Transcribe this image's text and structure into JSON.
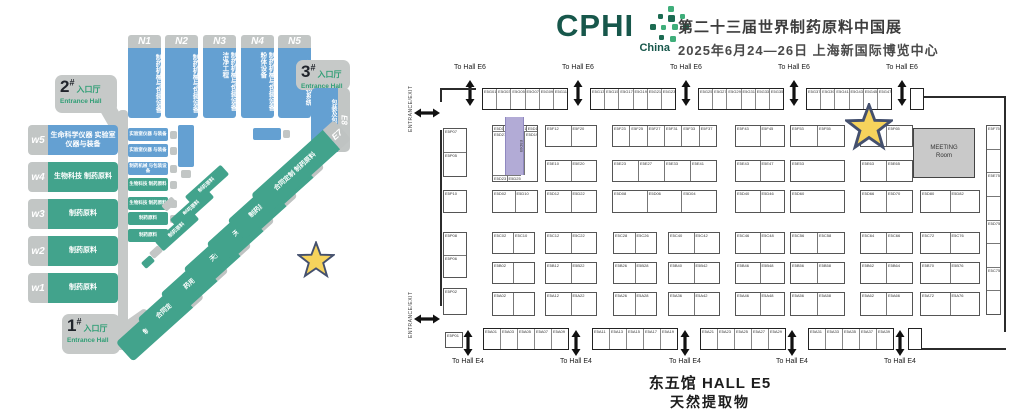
{
  "header": {
    "logo": "CPHI",
    "logo_sub": "China",
    "title": "第二十三届世界制药原料中国展",
    "date_venue": "2025年6月24—26日  上海新国际博览中心"
  },
  "venue_map": {
    "entrances": [
      {
        "num": "1",
        "hash": "#",
        "cn": "入口厅",
        "en": "Entrance Hall"
      },
      {
        "num": "2",
        "hash": "#",
        "cn": "入口厅",
        "en": "Entrance Hall"
      },
      {
        "num": "3",
        "hash": "#",
        "cn": "入口厅",
        "en": "Entrance Hall"
      }
    ],
    "n_halls": [
      {
        "id": "N1",
        "label": "制药机械与包装设备"
      },
      {
        "id": "N2",
        "label": "制药机械与包装设备"
      },
      {
        "id": "N3",
        "label": "制药机械与包装设备 洁净工程"
      },
      {
        "id": "N4",
        "label": "制药机械与包装设备 粉体设备"
      },
      {
        "id": "N5",
        "label": "包装及包材系统"
      }
    ],
    "w_halls": [
      {
        "id": "w5",
        "label": "生命科学仪器 实验室仪器与装备",
        "color": "blue"
      },
      {
        "id": "w4",
        "label": "生物科技 制药原料",
        "color": "green"
      },
      {
        "id": "w3",
        "label": "制药原料",
        "color": "green"
      },
      {
        "id": "w2",
        "label": "制药原料",
        "color": "green"
      },
      {
        "id": "w1",
        "label": "制药原料",
        "color": "green"
      }
    ],
    "e8": {
      "id": "E8",
      "label": "包装及包材系统"
    },
    "e_halls": [
      {
        "id": "E1",
        "label": "制药原料"
      },
      {
        "id": "E2",
        "label": "合同定制 制药原料"
      },
      {
        "id": "E3",
        "label": "药用辅料 制剂"
      },
      {
        "id": "E4",
        "label": "天然提取物"
      },
      {
        "id": "E5",
        "label": "天然提取物"
      },
      {
        "id": "E6",
        "label": "制药原料 药用辅料"
      },
      {
        "id": "E7",
        "label": "合同定制 制药原料"
      }
    ],
    "mid_boxes": [
      {
        "label": "实验室仪器 与装备",
        "color": "blue"
      },
      {
        "label": "实验室仪器 与装备",
        "color": "blue"
      },
      {
        "label": "制药机械 与包装设备",
        "color": "blue"
      },
      {
        "label": "生物科技 制药原料",
        "color": "green"
      },
      {
        "label": "生物科技 制药原料",
        "color": "green"
      },
      {
        "label": "制药原料",
        "color": "green"
      },
      {
        "label": "制药原料",
        "color": "green"
      }
    ],
    "small_diags": [
      "制药原料",
      "制药原料",
      "制药原料"
    ]
  },
  "floor_plan": {
    "to_hall_top": "To Hall E6",
    "to_hall_bottom": "To Hall E4",
    "entrance_exit": "ENTRANCE/EXIT",
    "meeting_room_line1": "MEETING",
    "meeting_room_line2": "Room",
    "hall_title": "东五馆  HALL E5",
    "hall_subtitle": "天然提取物",
    "wall_top": [
      [
        "E5G01",
        "E5G03",
        "E5G05",
        "E5G07",
        "E5G09",
        "E5G11"
      ],
      [
        "E5G13",
        "E5G15",
        "E5G17",
        "E5G19",
        "E5G21",
        "E5G23"
      ],
      [
        "E5G25",
        "E5G27",
        "E5G29",
        "E5G31",
        "E5G33",
        "E5G35"
      ],
      [
        "E5G37",
        "E5G39",
        "E5G41",
        "E5G43",
        "E5G45",
        "E5G47"
      ]
    ],
    "wall_bottom": [
      [
        "E5A01",
        "E5A03",
        "E5A05",
        "E5A07",
        "E5A09"
      ],
      [
        "E5A11",
        "E5A13",
        "E5A15",
        "E5A17",
        "E5A19"
      ],
      [
        "E5A21",
        "E5A23",
        "E5A25",
        "E5A27",
        "E5A29"
      ],
      [
        "E5A31",
        "E5A33",
        "E5A35",
        "E5A37",
        "E5A39"
      ]
    ],
    "rowF": [
      "E5F12",
      "E5F20",
      "E5F23",
      "E5F25",
      "E5F27",
      "E5F31",
      "E5F33",
      "E5F37",
      "E5F43",
      "E5F45",
      "E5F53",
      "E5F55",
      "E5F63",
      "E5F65"
    ],
    "rowE": [
      "E5E10",
      "E5E20",
      "E5E23",
      "E5E27",
      "E5E33",
      "E5E41",
      "E5E43",
      "E5E47",
      "E5E53",
      "E5E63",
      "E5E65"
    ],
    "rowD": [
      "E5D02",
      "E5D10",
      "E5D12",
      "E5D22",
      "E5D08",
      "E5D06",
      "E5D04",
      "E5D40",
      "E5D46",
      "E5D60",
      "E5D66",
      "E5D70",
      "E5D80",
      "E5D82"
    ],
    "rowC": [
      "E5C02",
      "E5C10",
      "E5C12",
      "E5C22",
      "E5C28",
      "E5C26",
      "E5C40",
      "E5C42",
      "E5C46",
      "E5C48",
      "E5C56",
      "E5C58",
      "E5C64",
      "E5C66",
      "E5C72",
      "E5C76"
    ],
    "rowB": [
      "E5B02",
      "",
      "E5B12",
      "E5B22",
      "E5B26",
      "E5B28",
      "E5B40",
      "E5B42",
      "E5B46",
      "E5B48",
      "E5B56",
      "E5B58",
      "E5B62",
      "E5B64",
      "E5B70",
      "E5B76"
    ],
    "rowA": [
      "E5A02",
      "",
      "E5A12",
      "E5A22",
      "E5A26",
      "E5A28",
      "E5A36",
      "E5A42",
      "E5A46",
      "E5A48",
      "E5A56",
      "E5A58",
      "E5A62",
      "E5A66",
      "E5A72",
      "E5A76"
    ],
    "p_col": [
      "E5P07",
      "E5P05",
      "E5P10",
      "E5P08",
      "E5P06",
      "E5P02"
    ],
    "right_col": [
      "E5F75",
      "",
      "E5E75",
      "",
      "E5D75",
      "",
      "E5C75",
      ""
    ],
    "corner_booth": "E5P01",
    "purple_block": {
      "cells": [
        "E5D11",
        "E5D13",
        "E5D15",
        "E5D17",
        "E5D21",
        "E5D19",
        "E5D23",
        "E5D25"
      ],
      "center": "E5D05"
    }
  },
  "colors": {
    "hall_blue": "#64a0d2",
    "hall_green": "#42a38c",
    "gray": "#c2c6c5",
    "entrance_green": "#2f9e75",
    "logo_green": "#17574b",
    "star_fill": "#f6d35c",
    "star_stroke": "#44506e",
    "highlight_purple": "#b2abd6"
  }
}
